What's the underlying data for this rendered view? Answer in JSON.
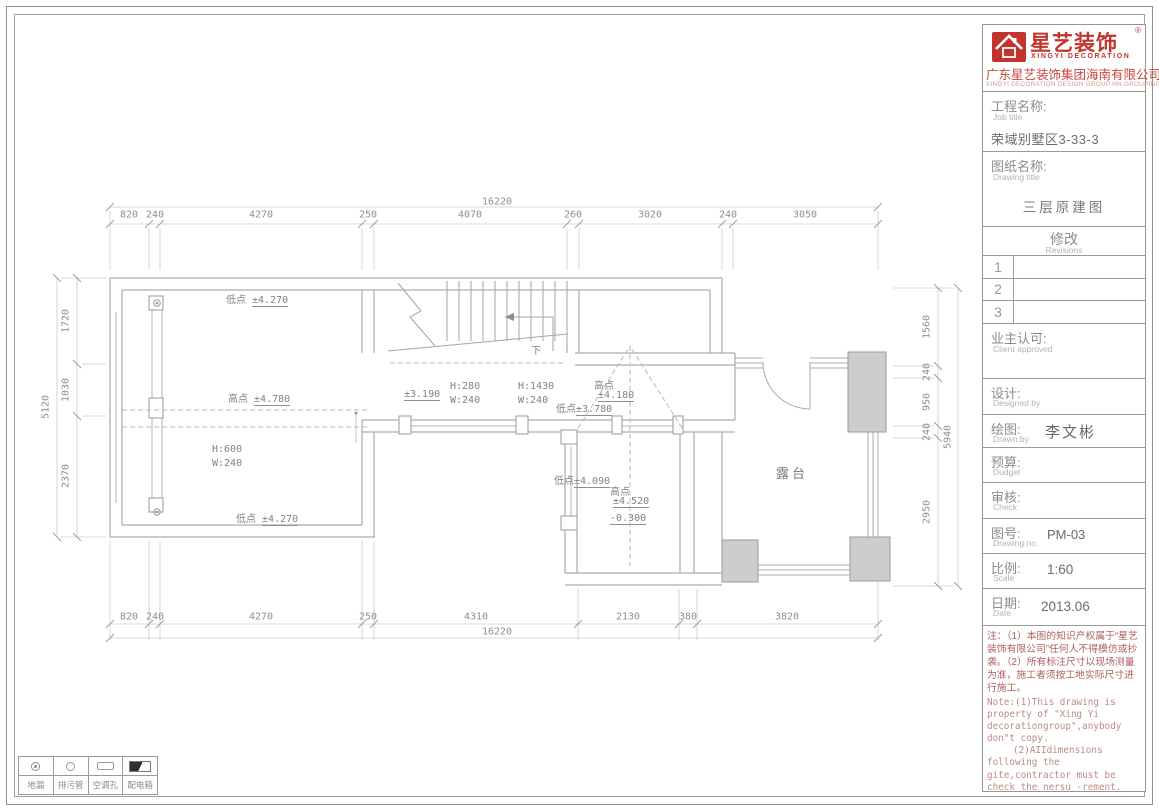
{
  "logo": {
    "brand_cn": "星艺装饰",
    "brand_en": "XINGYI DECORATION",
    "reg_mark": "®",
    "company_cn": "广东星艺装饰集团海南有限公司",
    "company_en": "XINGYI DECORATION DESIGN GROUP HN.GROUPING",
    "brand_color": "#c2342e"
  },
  "title_block": {
    "job": {
      "label": "工程名称:",
      "sub": "Job title",
      "value": "荣域别墅区3-33-3"
    },
    "drawing": {
      "label": "图纸名称:",
      "sub": "Drawing title",
      "value": "三层原建图"
    },
    "revisions": {
      "label": "修改",
      "sub": "Revisions",
      "rows": [
        "1",
        "2",
        "3"
      ]
    },
    "client": {
      "label": "业主认可:",
      "sub": "Client approved"
    },
    "designed": {
      "label": "设计:",
      "sub": "Designed by",
      "value": ""
    },
    "drawn": {
      "label": "绘图:",
      "sub": "Drawn by",
      "value": "李文彬"
    },
    "budget": {
      "label": "预算:",
      "sub": "Dudget",
      "value": ""
    },
    "check": {
      "label": "审核:",
      "sub": "Check",
      "value": ""
    },
    "drawing_no": {
      "label": "图号:",
      "sub": "Drawing no.",
      "value": "PM-03"
    },
    "scale": {
      "label": "比例:",
      "sub": "Scale",
      "value": "1:60"
    },
    "date": {
      "label": "日期:",
      "sub": "Date",
      "value": "2013.06"
    }
  },
  "notes": {
    "cn": "注：（1）本图的知识产权属于“星艺装饰有限公司”任何人不得模仿或抄袭。（2）所有标注尺寸以现场测量为准，施工者须按工地实际尺寸进行施工。",
    "en1": "Note:(1)This drawing is property of \"Xing Yi decorationgroup\",anybody don\"t copy.",
    "en2": "(2)AIIdimensions following the gite,contractor must be check the nersu -rement."
  },
  "legend": {
    "items": [
      {
        "icon": "floor-drain",
        "label": "地漏"
      },
      {
        "icon": "sewage-pipe",
        "label": "排污管"
      },
      {
        "icon": "ac-hole",
        "label": "空调孔"
      },
      {
        "icon": "power-box",
        "label": "配电箱"
      }
    ]
  },
  "plan": {
    "annotations": [
      {
        "x": 226,
        "y": 291,
        "pre": "低点 ",
        "val": "±4.270"
      },
      {
        "x": 228,
        "y": 390,
        "pre": "高点 ",
        "val": "±4.780"
      },
      {
        "x": 212,
        "y": 444,
        "pre": "H:600"
      },
      {
        "x": 212,
        "y": 458,
        "pre": "W:240"
      },
      {
        "x": 236,
        "y": 510,
        "pre": "低点 ",
        "val": "±4.270"
      },
      {
        "x": 404,
        "y": 389,
        "val": "±3.190"
      },
      {
        "x": 450,
        "y": 381,
        "pre": "H:280"
      },
      {
        "x": 450,
        "y": 395,
        "pre": "W:240"
      },
      {
        "x": 518,
        "y": 381,
        "pre": "H:1430"
      },
      {
        "x": 518,
        "y": 395,
        "pre": "W:240"
      },
      {
        "x": 594,
        "y": 377,
        "pre": "高点"
      },
      {
        "x": 598,
        "y": 390,
        "val": "±4.180"
      },
      {
        "x": 556,
        "y": 400,
        "pre": "低点",
        "val": "±3.780"
      },
      {
        "x": 554,
        "y": 472,
        "pre": "低点",
        "val": "±4.090"
      },
      {
        "x": 610,
        "y": 483,
        "pre": "高点"
      },
      {
        "x": 613,
        "y": 496,
        "val": "±4.520"
      },
      {
        "x": 610,
        "y": 513,
        "val": "-0.300"
      },
      {
        "x": 531,
        "y": 342,
        "pre": "下"
      },
      {
        "x": 776,
        "y": 463,
        "pre": "露台",
        "big": true
      }
    ],
    "dims": [
      {
        "t": "16220",
        "x": 497,
        "y": 202
      },
      {
        "t": "820",
        "x": 129,
        "y": 215
      },
      {
        "t": "240",
        "x": 155,
        "y": 215
      },
      {
        "t": "4270",
        "x": 261,
        "y": 215
      },
      {
        "t": "250",
        "x": 368,
        "y": 215
      },
      {
        "t": "4070",
        "x": 470,
        "y": 215
      },
      {
        "t": "260",
        "x": 573,
        "y": 215
      },
      {
        "t": "3020",
        "x": 650,
        "y": 215
      },
      {
        "t": "240",
        "x": 728,
        "y": 215
      },
      {
        "t": "3050",
        "x": 805,
        "y": 215
      },
      {
        "t": "820",
        "x": 129,
        "y": 617
      },
      {
        "t": "240",
        "x": 155,
        "y": 617
      },
      {
        "t": "4270",
        "x": 261,
        "y": 617
      },
      {
        "t": "250",
        "x": 368,
        "y": 617
      },
      {
        "t": "4310",
        "x": 476,
        "y": 617
      },
      {
        "t": "2130",
        "x": 628,
        "y": 617
      },
      {
        "t": "380",
        "x": 688,
        "y": 617
      },
      {
        "t": "3820",
        "x": 787,
        "y": 617
      },
      {
        "t": "16220",
        "x": 497,
        "y": 632
      },
      {
        "t": "1720",
        "x": 66,
        "y": 321,
        "v": true
      },
      {
        "t": "1030",
        "x": 66,
        "y": 390,
        "v": true
      },
      {
        "t": "2370",
        "x": 66,
        "y": 476,
        "v": true
      },
      {
        "t": "5120",
        "x": 46,
        "y": 407,
        "v": true
      },
      {
        "t": "1560",
        "x": 927,
        "y": 327,
        "v": true
      },
      {
        "t": "240",
        "x": 927,
        "y": 372,
        "v": true
      },
      {
        "t": "950",
        "x": 927,
        "y": 402,
        "v": true
      },
      {
        "t": "240",
        "x": 927,
        "y": 432,
        "v": true
      },
      {
        "t": "2950",
        "x": 927,
        "y": 512,
        "v": true
      },
      {
        "t": "5940",
        "x": 948,
        "y": 437,
        "v": true
      }
    ]
  }
}
